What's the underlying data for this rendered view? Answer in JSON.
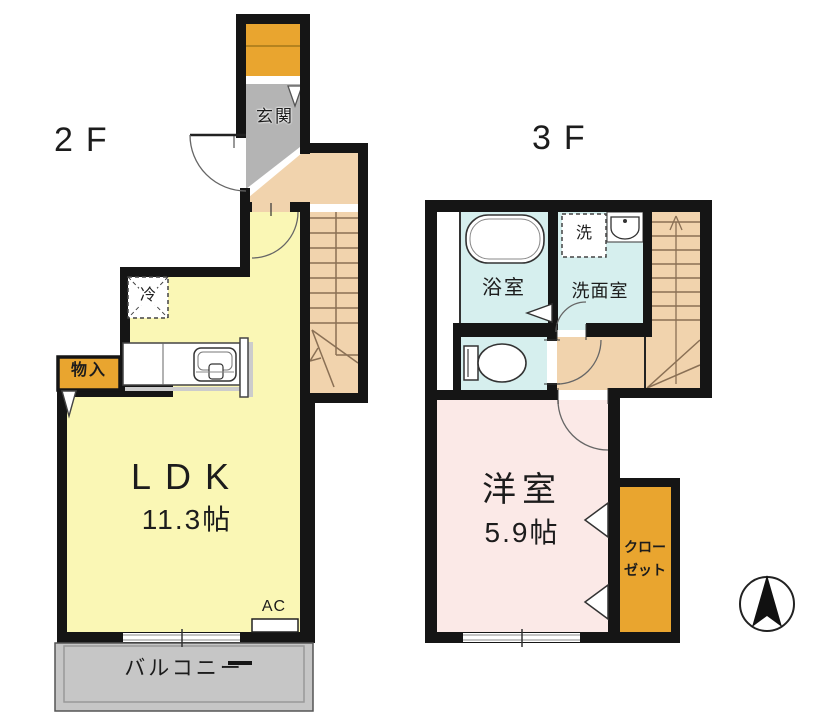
{
  "floors": [
    {
      "label": "2F",
      "rooms": {
        "genkan": {
          "label": "玄関"
        },
        "ldk": {
          "label": "LDK",
          "size": "11.3帖"
        },
        "refrigerator": {
          "label": "冷"
        },
        "storage": {
          "label": "物入"
        },
        "ac": {
          "label": "AC"
        },
        "balcony": {
          "label": "バルコニー"
        }
      }
    },
    {
      "label": "3F",
      "rooms": {
        "bathroom": {
          "label": "浴室"
        },
        "washer": {
          "label": "洗"
        },
        "washroom": {
          "label": "洗面室"
        },
        "western_room": {
          "label": "洋室",
          "size": "5.9帖"
        },
        "closet": {
          "line1": "クロー",
          "line2": "ゼット"
        }
      }
    }
  ],
  "compass": {
    "direction": "N"
  },
  "colors": {
    "wall": "#151515",
    "hall_stairs": "#f1d3ad",
    "ldk_yellow": "#faf7b5",
    "accent_orange": "#e9a52f",
    "genkan_gray": "#b4b4b4",
    "balcony_gray": "#c6c6c6",
    "wet_cyan": "#d6efee",
    "western_pink": "#fbe9e7",
    "stair_line": "#8a7055"
  }
}
